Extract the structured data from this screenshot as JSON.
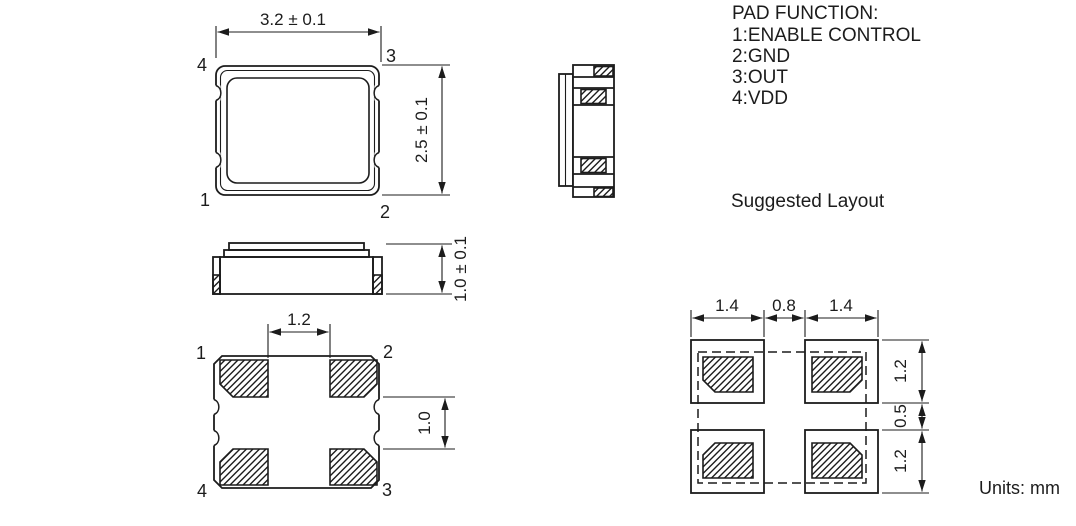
{
  "pad_function": {
    "title": "PAD FUNCTION:",
    "items": [
      "1:ENABLE CONTROL",
      "2:GND",
      "3:OUT",
      "4:VDD"
    ]
  },
  "labels": {
    "suggested_layout": "Suggested Layout",
    "units": "Units: mm"
  },
  "top_view": {
    "dim_width": "3.2 ± 0.1",
    "dim_height": "2.5 ± 0.1",
    "pin_top_left": "4",
    "pin_top_right": "3",
    "pin_bottom_left": "1",
    "pin_bottom_right": "2"
  },
  "side_view": {
    "dim_height": "1.0 ± 0.1"
  },
  "bottom_view": {
    "dim_pad_span": "1.2",
    "dim_pad_gap": "1.0",
    "pin_top_left": "1",
    "pin_top_right": "2",
    "pin_bottom_left": "4",
    "pin_bottom_right": "3"
  },
  "layout": {
    "dim_left_pad": "1.4",
    "dim_gap": "0.8",
    "dim_right_pad": "1.4",
    "dim_top_pad": "1.2",
    "dim_mid_gap": "0.5",
    "dim_bottom_pad": "1.2"
  },
  "colors": {
    "line": "#1c1c1c",
    "background": "#ffffff"
  }
}
